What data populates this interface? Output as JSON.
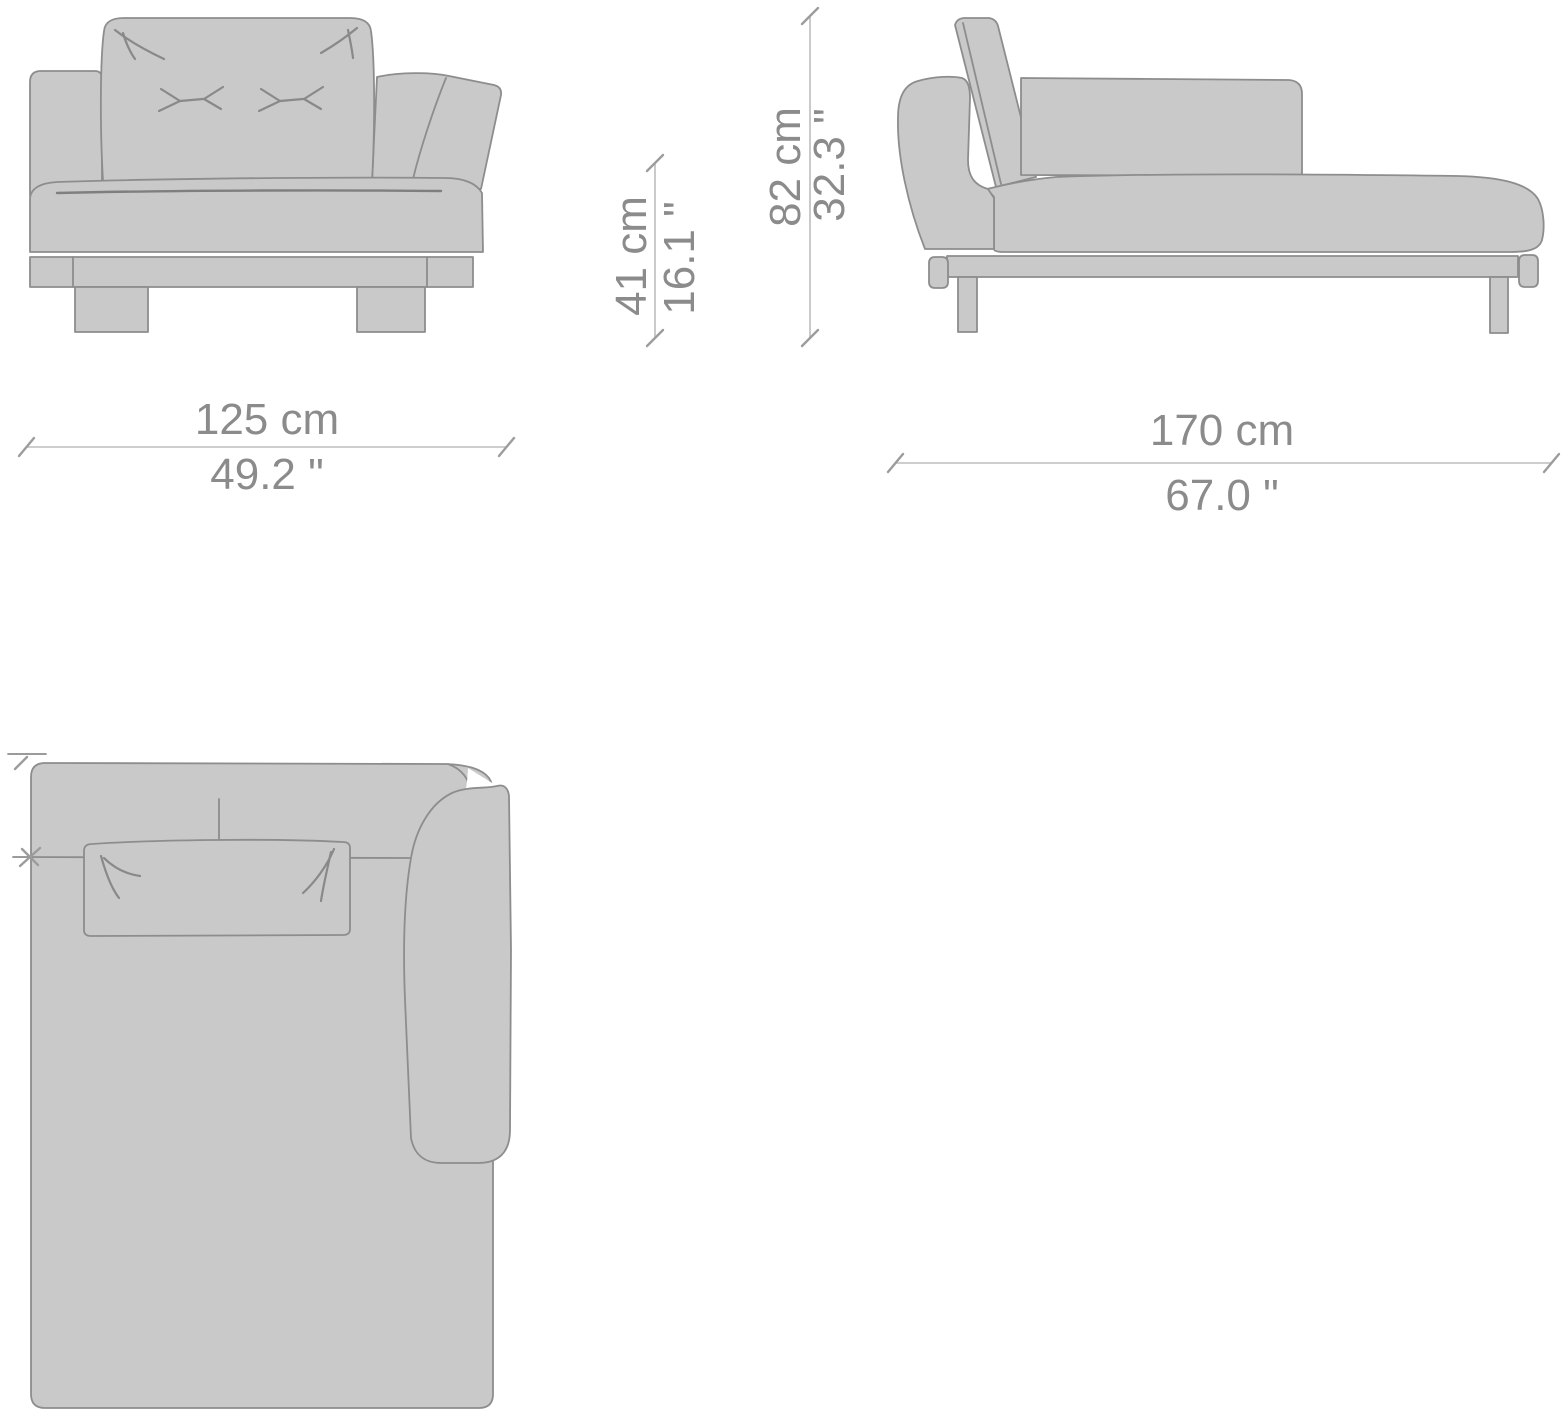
{
  "page": {
    "description": "Technical dimension drawing of a one-arm chaise longue sofa module shown in front, side and top orthographic views"
  },
  "dimensions": {
    "front_width_cm": "125 cm",
    "front_width_in": "49.2 \"",
    "side_length_cm": "170 cm",
    "side_length_in": "67.0 \"",
    "seat_height_cm": "41 cm",
    "seat_height_in": "16.1 \"",
    "overall_height_cm": "82 cm",
    "overall_height_in": "32.3 \""
  },
  "views": {
    "front": "front-elevation",
    "side": "side-elevation",
    "top": "top-plan"
  },
  "colors": {
    "upholstery_fill": "#c9c9c9",
    "outline": "#8d8d8d",
    "dimension_line": "#bdbdbd",
    "dimension_text": "#8b8b8b",
    "background": "#ffffff"
  }
}
